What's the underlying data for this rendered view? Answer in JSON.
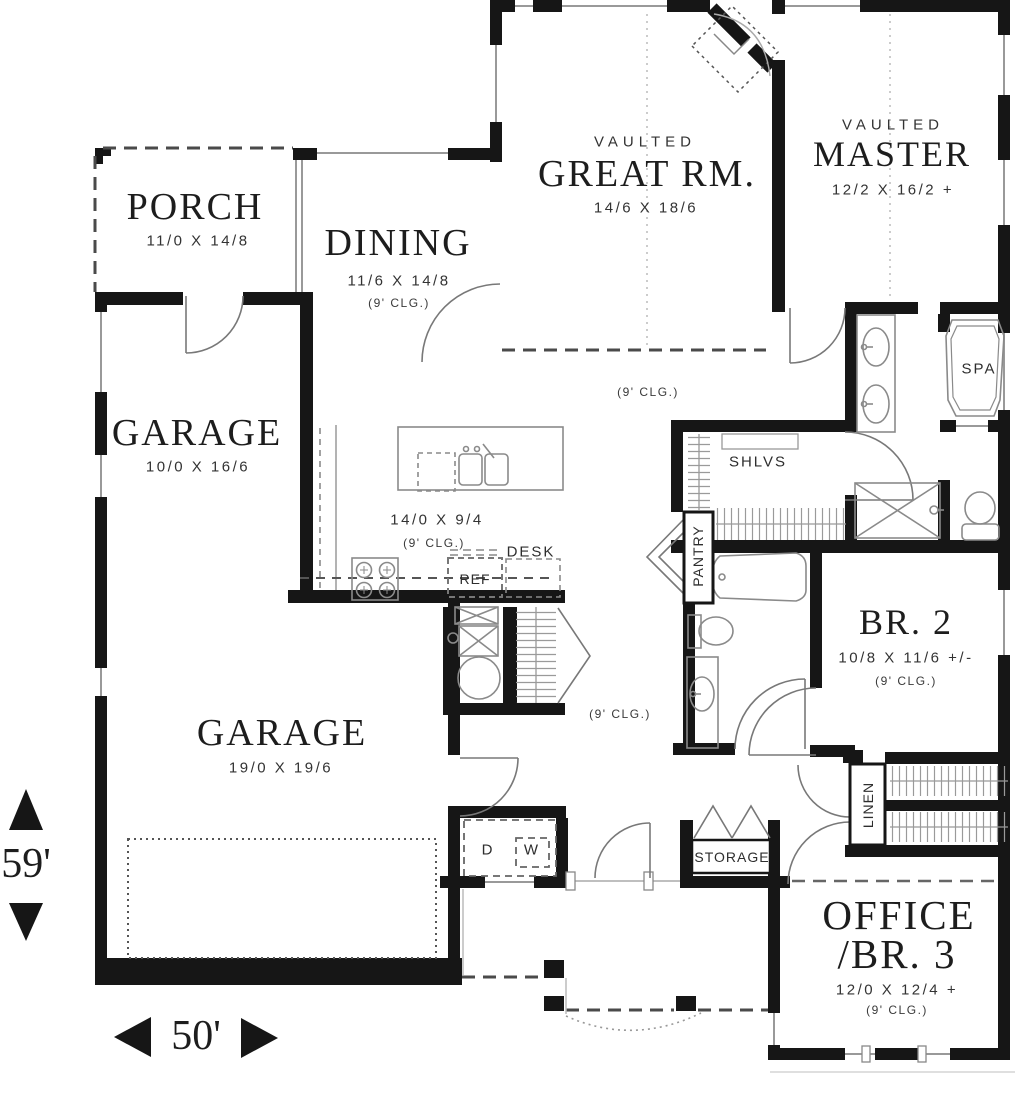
{
  "plan": {
    "rooms": {
      "porch": {
        "name": "PORCH",
        "dims": "11/0 X 14/8"
      },
      "dining": {
        "name": "DINING",
        "dims": "11/6 X 14/8",
        "clg": "(9' CLG.)"
      },
      "great_rm": {
        "vault": "VAULTED",
        "name": "GREAT RM.",
        "dims": "14/6 X 18/6",
        "clg": "(9' CLG.)"
      },
      "master": {
        "vault": "VAULTED",
        "name": "MASTER",
        "dims": "12/2 X 16/2 +"
      },
      "garage_upper": {
        "name": "GARAGE",
        "dims": "10/0 X 16/6"
      },
      "kitchen": {
        "dims": "14/0 X 9/4",
        "clg": "(9' CLG.)"
      },
      "br2": {
        "name": "BR. 2",
        "dims": "10/8 X 11/6 +/-",
        "clg": "(9' CLG.)"
      },
      "hall": {
        "clg": "(9' CLG.)"
      },
      "garage_lower": {
        "name": "GARAGE",
        "dims": "19/0 X 19/6"
      },
      "office_br3": {
        "name_line1": "OFFICE",
        "name_line2": "/BR. 3",
        "dims": "12/0 X 12/4 +",
        "clg": "(9' CLG.)"
      }
    },
    "fixtures": {
      "desk": "DESK",
      "ref": "REF",
      "shelves": "SHLVS",
      "pantry": "PANTRY",
      "spa": "SPA",
      "storage": "STORAGE",
      "linen": "LINEN",
      "dryer": "D",
      "washer": "W"
    },
    "overall_dimensions": {
      "depth": "59'",
      "width": "50'"
    },
    "colors": {
      "wall": "#161616",
      "fixture_line": "#8a8a8a",
      "text": "#1d1d1d"
    }
  }
}
